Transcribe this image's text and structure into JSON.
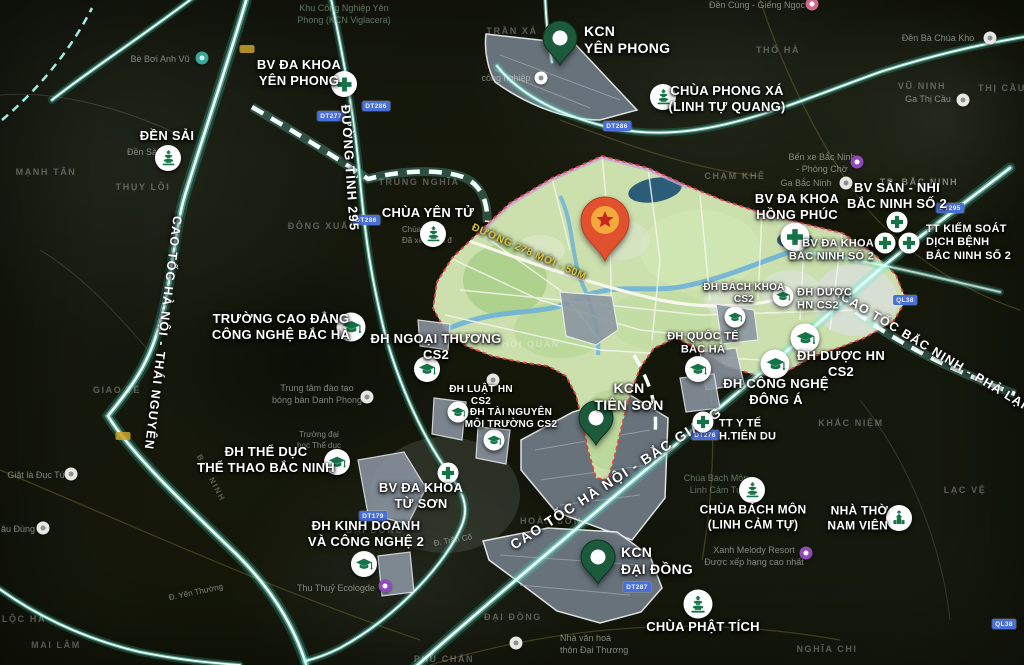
{
  "colors": {
    "accent_green": "#157347",
    "pin_green": "#1d5a3c",
    "road_glow": "#9ef7e7",
    "star_pin_body": "#e2512e",
    "star_pin_circle": "#f3a93c",
    "star_pin_star": "#c4281c",
    "plan_fill": "#cbe0ad",
    "plan_border": "#e04545",
    "badge_blue": "#4a6fd8",
    "road_label_yellow": "#d8c53e"
  },
  "icons": {
    "hospital": "cross-icon",
    "university": "graduation-cap-icon",
    "pagoda": "pagoda-icon",
    "church": "church-icon",
    "industrial_zone": "map-pin-icon",
    "main_site": "star-pin-icon"
  },
  "plan": {
    "road_label": "ĐƯỜNG 278 MỚI - 50M"
  },
  "roads": {
    "dt295": "ĐƯỜNG TỈNH 295",
    "ct_hanoi_thainguyen": "CAO TỐC HÀ NỘI - THÁI NGUYÊN",
    "ct_hanoi_bacgiang": "CAO TỐC HÀ NỘI - BẮC GIANG",
    "ct_bacninh_phalai": "CAO TỐC BẮC NINH - PHẢ LẠI"
  },
  "pois": {
    "kcn_yen_phong": {
      "text": "KCN\nYÊN PHONG",
      "type": "industrial_zone"
    },
    "bv_dk_yen_phong": {
      "text": "BV ĐA KHOA\nYÊN PHONG",
      "type": "hospital"
    },
    "chua_phong_xa": {
      "text": "CHÙA PHONG XÁ\n(LINH TỰ QUANG)",
      "type": "pagoda"
    },
    "den_sai": {
      "text": "ĐỀN SẢI",
      "type": "pagoda"
    },
    "chua_yen_tu": {
      "text": "CHÙA YÊN TỬ",
      "type": "pagoda"
    },
    "bv_hong_phuc": {
      "text": "BV ĐA KHOA\nHỒNG PHÚC",
      "type": "hospital"
    },
    "bv_san_nhi": {
      "text": "BV SẢN - NHI\nBẮC NINH SỐ 2",
      "type": "hospital"
    },
    "bv_bac_ninh_2": {
      "text": "BV ĐA KHOA\nBẮC NINH SỐ 2",
      "type": "hospital"
    },
    "tt_kiem_soat": {
      "text": "TT KIỂM SOÁT\nDỊCH BỆNH\nBẮC NINH SỐ 2",
      "type": "hospital"
    },
    "truong_cd_bac_ha": {
      "text": "TRƯỜNG CAO ĐẲNG\nCÔNG NGHỆ BẮC HÀ",
      "type": "university"
    },
    "dh_ngoai_thuong": {
      "text": "ĐH NGOẠI THƯƠNG\nCS2",
      "type": "university"
    },
    "dh_luat": {
      "text": "ĐH LUẬT HN\nCS2",
      "type": "university"
    },
    "dh_tai_nguyen": {
      "text": "ĐH TÀI NGUYÊN\nMÔI TRƯỜNG CS2",
      "type": "university"
    },
    "dh_bach_khoa": {
      "text": "ĐH BÁCH KHOA\nCS2",
      "type": "university"
    },
    "dh_duoc_top": {
      "text": "ĐH DƯỢC\nHN CS2",
      "type": "university"
    },
    "dh_quoc_te": {
      "text": "ĐH QUỐC TẾ\nBẮC HÀ",
      "type": "university"
    },
    "dh_duoc_bottom": {
      "text": "ĐH DƯỢC HN\nCS2",
      "type": "university"
    },
    "dh_cong_nghe_dong_a": {
      "text": "ĐH CÔNG NGHỆ\nĐÔNG Á",
      "type": "university"
    },
    "kcn_tien_son": {
      "text": "KCN\nTIÊN SƠN",
      "type": "industrial_zone"
    },
    "tt_y_te_tien_du": {
      "text": "TT Y TẾ\nH.TIÊN DU",
      "type": "hospital"
    },
    "dh_the_duc": {
      "text": "ĐH THỂ DỤC\nTHỂ THAO BẮC NINH",
      "type": "university"
    },
    "bv_tu_son": {
      "text": "BV ĐA KHOA\nTỪ SƠN",
      "type": "hospital"
    },
    "dh_kinh_doanh": {
      "text": "ĐH KINH DOANH\nVÀ CÔNG NGHỆ 2",
      "type": "university"
    },
    "kcn_dai_dong": {
      "text": "KCN\nĐẠI ĐỒNG",
      "type": "industrial_zone"
    },
    "chua_bach_mon": {
      "text": "CHÙA BÁCH MÔN\n(LINH CẢM TỰ)",
      "type": "pagoda"
    },
    "nha_tho_nam_vien": {
      "text": "NHÀ THỜ\nNAM VIÊN",
      "type": "church"
    },
    "chua_phat_tich": {
      "text": "CHÙA PHẬT TÍCH",
      "type": "pagoda"
    }
  },
  "bg": [
    {
      "t": "Khu Công Nghiệp Yên\nPhong (KCN Viglacera)"
    },
    {
      "t": "TRẦN XÁ"
    },
    {
      "t": "Đền Cùng - Giếng Ngọc"
    },
    {
      "t": "Đền Bà Chúa Kho"
    },
    {
      "t": "THỔ HÀ"
    },
    {
      "t": "VŨ NINH"
    },
    {
      "t": "Ga Thị Cầu"
    },
    {
      "t": "THỊ CẦU"
    },
    {
      "t": "Bến xe Bắc Ninh\n- Phòng Chờ"
    },
    {
      "t": "CHẠM KHÊ"
    },
    {
      "t": "TP. BẮC NINH"
    },
    {
      "t": "Ga Bắc Ninh"
    },
    {
      "t": "TRUNG NGHĨA"
    },
    {
      "t": "ĐÔNG XUẤT"
    },
    {
      "t": "MẠNH TÂN"
    },
    {
      "t": "THỤY LÔI"
    },
    {
      "t": "GIAO TẾ"
    },
    {
      "t": "Bè Bơi Anh Vũ"
    },
    {
      "t": "Đền Sải"
    },
    {
      "t": "Chùa Yên T\nĐã xem gần đ"
    },
    {
      "t": "Trung tâm đào tạo\nbóng bàn Danh Phong"
    },
    {
      "t": "Trường đại\nhọc Thể dục"
    },
    {
      "t": "Giặt là Đục Tú"
    },
    {
      "t": "âu Đùng"
    },
    {
      "t": "LỘC HÀ"
    },
    {
      "t": "MAI LÂM"
    },
    {
      "t": "Thu Thuỷ Ecologde"
    },
    {
      "t": "ĐẠI ĐỒNG"
    },
    {
      "t": "HOÀN SƠN"
    },
    {
      "t": "ĐẠI ĐỒNG"
    },
    {
      "t": "Nhà văn hoá\nthôn Đại Thương"
    },
    {
      "t": "PHÙ CHẨN"
    },
    {
      "t": "NGHĨA CHI"
    },
    {
      "t": "KHẮC NIỆM"
    },
    {
      "t": "LẠC VỆ"
    },
    {
      "t": "Xanh Melody Resort\nĐược xếp hạng cao nhất"
    },
    {
      "t": "HỒI QUAN"
    },
    {
      "t": "Chùa Bách Môn\nLinh Cảm Tự"
    },
    {
      "t": "công nghiệp"
    },
    {
      "t": "Đ. Yên Thường"
    },
    {
      "t": "BẮC NINH"
    },
    {
      "t": "Đ. Trần Cố"
    }
  ],
  "badges": [
    {
      "t": "DT277"
    },
    {
      "t": "DT286"
    },
    {
      "t": "DT286"
    },
    {
      "t": "DT286"
    },
    {
      "t": "DT276"
    },
    {
      "t": "DT179"
    },
    {
      "t": "DT287"
    },
    {
      "t": "QL38"
    },
    {
      "t": "QL38"
    },
    {
      "t": "DT295"
    }
  ]
}
